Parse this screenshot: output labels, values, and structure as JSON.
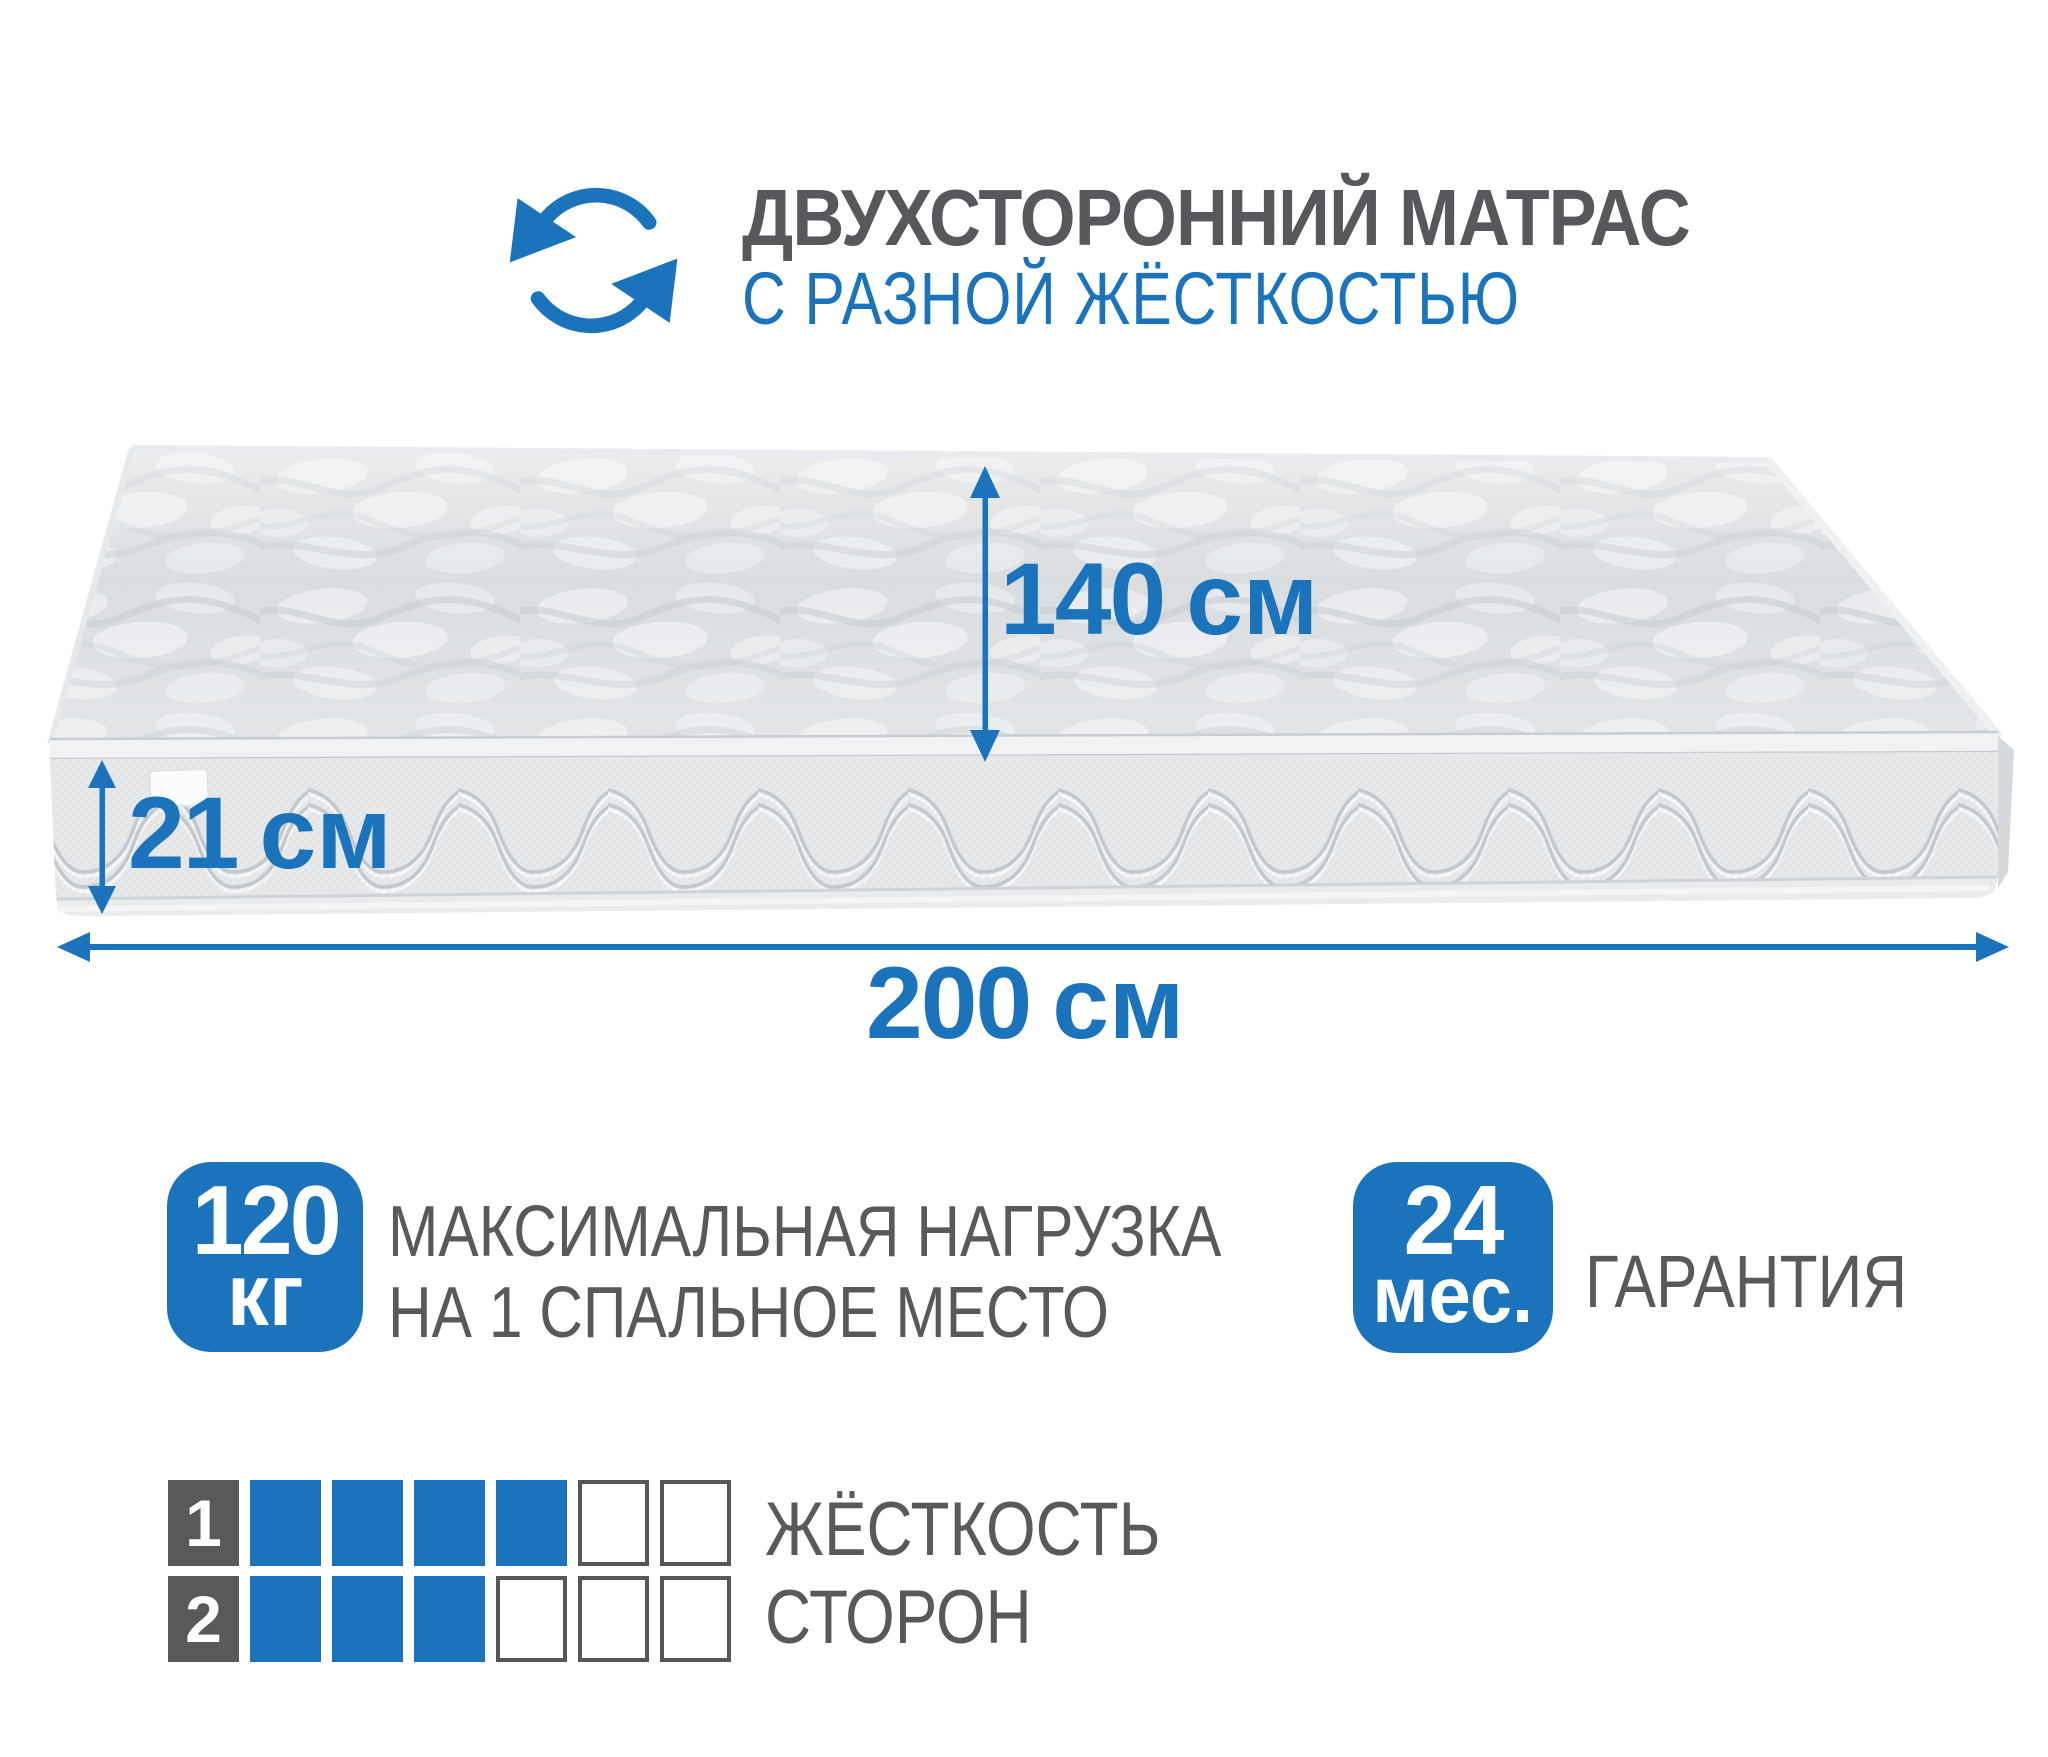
{
  "colors": {
    "accent_blue": "#1b74bb",
    "text_gray": "#58595b",
    "mattress_top_gray": "#d7dadd",
    "mattress_side_gray": "#e6e8ea"
  },
  "header": {
    "icon": "rotate-arrows-icon",
    "title": "ДВУХСТОРОННИЙ МАТРАС",
    "subtitle": "С РАЗНОЙ ЖЁСТКОСТЬЮ"
  },
  "dimensions": {
    "length": {
      "value": "140",
      "unit": "см"
    },
    "height": {
      "value": "21",
      "unit": "см"
    },
    "width": {
      "value": "200",
      "unit": "см"
    }
  },
  "features": [
    {
      "badge_value": "120",
      "badge_unit": "кг",
      "label_lines": [
        "МАКСИМАЛЬНАЯ НАГРУЗКА",
        "НА 1 СПАЛЬНОЕ МЕСТО"
      ]
    },
    {
      "badge_value": "24",
      "badge_unit": "мес.",
      "label_lines": [
        "ГАРАНТИЯ"
      ]
    }
  ],
  "firmness_scale": {
    "rows": [
      {
        "label": "1",
        "filled": 4,
        "total": 6
      },
      {
        "label": "2",
        "filled": 3,
        "total": 6
      }
    ],
    "caption_lines": [
      "ЖЁСТКОСТЬ",
      "СТОРОН"
    ]
  }
}
